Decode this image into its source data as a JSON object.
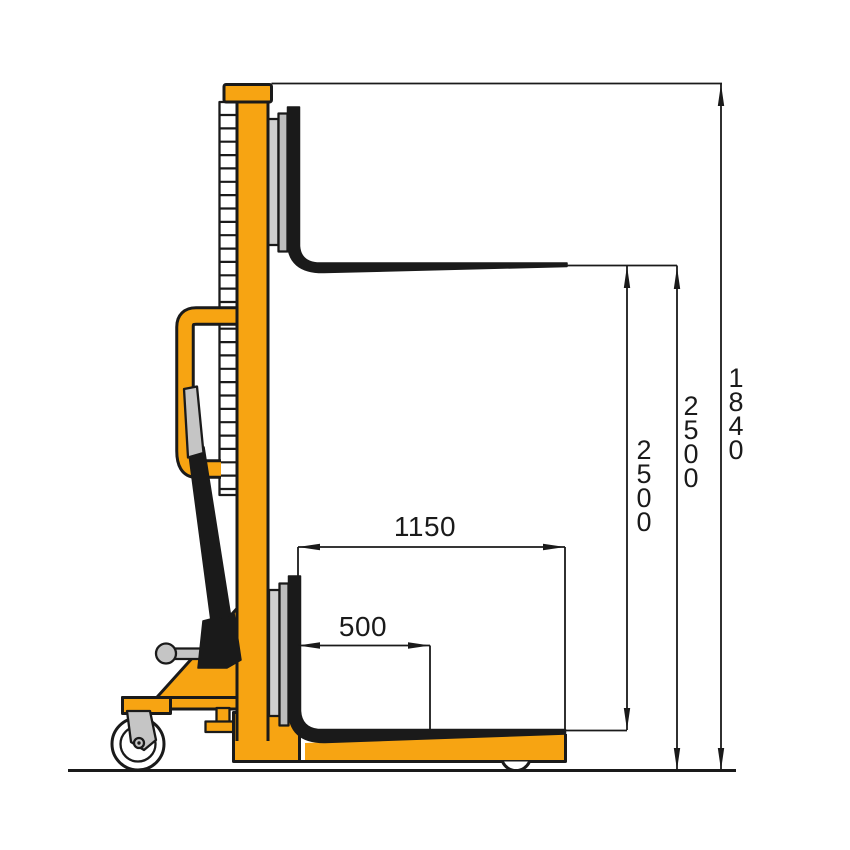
{
  "diagram": {
    "type": "technical-drawing",
    "subject": "manual hydraulic hand stacker - side view with dimensions",
    "units": "mm",
    "colors": {
      "body": "#F7A412",
      "line": "#1A1A1A",
      "carriage_light": "#CFCFCF",
      "carriage_mid": "#BDBDBD",
      "grip": "#C5C5C5",
      "wheel": "#FFFFFF",
      "background": "#FFFFFF"
    },
    "dim_labels": {
      "overall_height": "1840",
      "max_lift_height": "2500",
      "lift_travel": "2500",
      "fork_length": "1150",
      "load_center": "500"
    }
  }
}
